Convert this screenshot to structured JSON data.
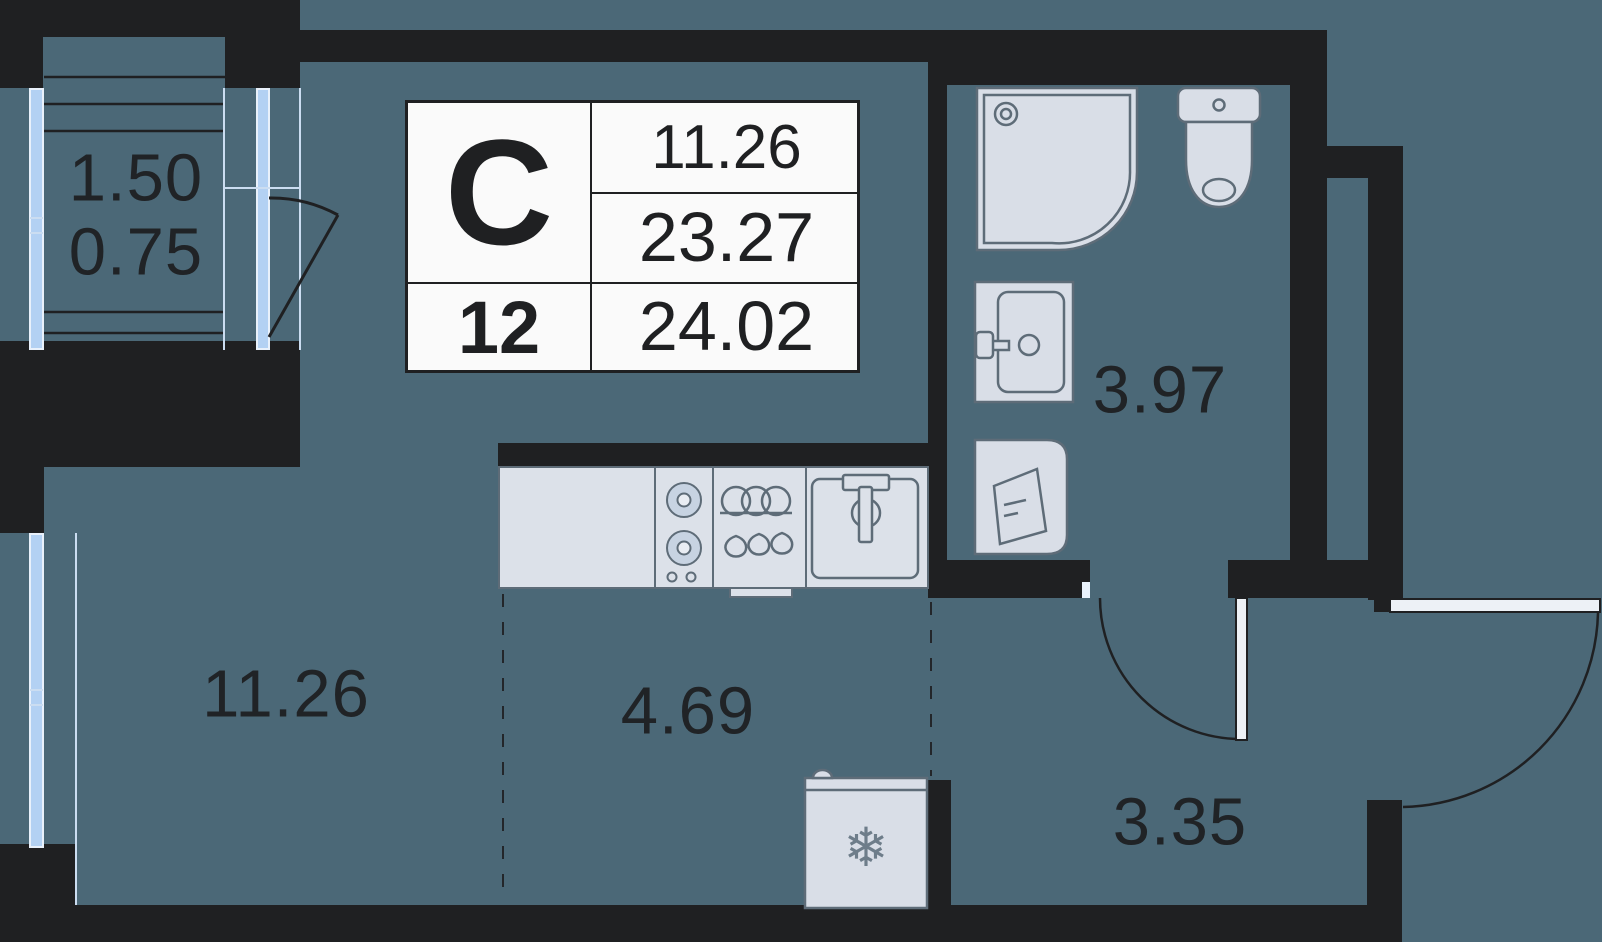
{
  "unit_card": {
    "type_letter": "С",
    "floor_number": "12",
    "room_area": "11.26",
    "area_without_balcony": "23.27",
    "total_area": "24.02"
  },
  "room_labels": {
    "balcony_area": "1.50",
    "balcony_area_reduced": "0.75",
    "living_area": "11.26",
    "kitchen_area": "4.69",
    "bathroom_area": "3.97",
    "hallway_area": "3.35"
  },
  "icons": {
    "freezer_snowflake": "❄"
  },
  "colors": {
    "background": "#4B6877",
    "wall": "#1F2022",
    "glazing": "#B3D1F3",
    "glazing_frame": "#E9F1FB",
    "fixture_fill": "#D9DEE7",
    "fixture_stroke": "#5E6C78",
    "card_background": "#FAFAFA",
    "text": "#202326"
  }
}
